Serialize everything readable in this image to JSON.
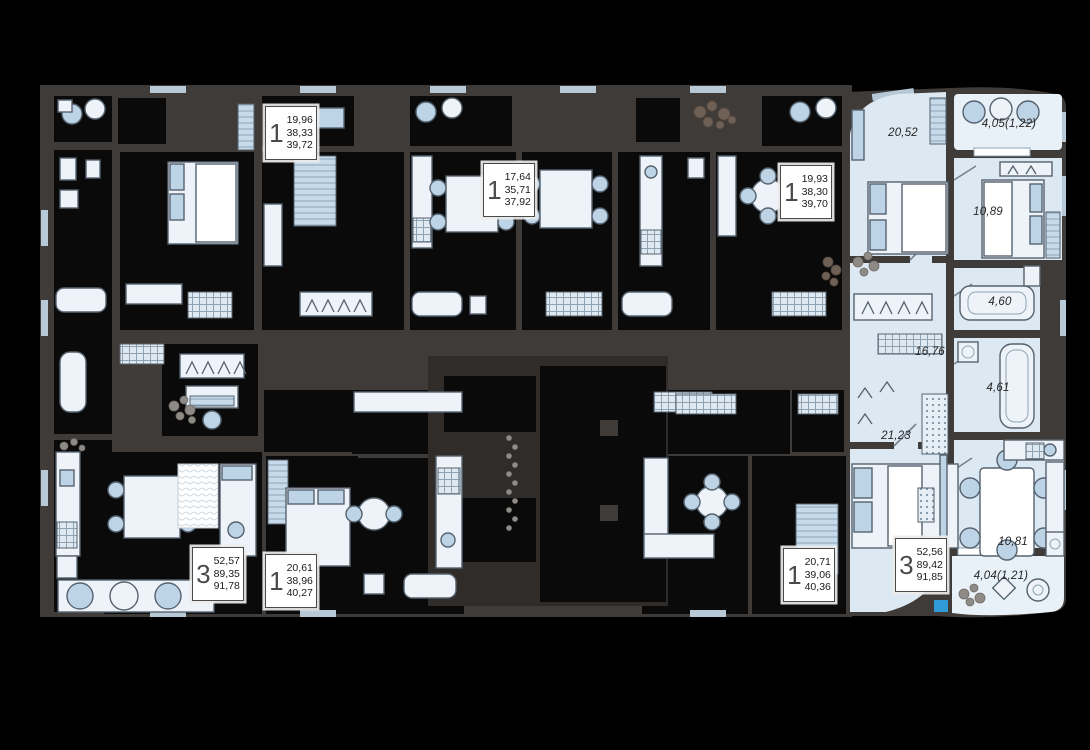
{
  "plan": {
    "name": "residential-floor-plan",
    "colors": {
      "background": "#000000",
      "wall": "#3f3b38",
      "room_dark": "#0a0a0a",
      "apartment_floor": "#dce8f2",
      "balcony_floor": "#e9f1f8",
      "furniture": "#bdd4e7",
      "entrance_marker": "#2f9ad6",
      "info_box_bg": "#ffffff"
    }
  },
  "apartment": {
    "name": "highlighted-apartment",
    "rooms": [
      {
        "label": "20,52"
      },
      {
        "label": "4,05(1,22)"
      },
      {
        "label": "10,89"
      },
      {
        "label": "4,60"
      },
      {
        "label": "4,61"
      },
      {
        "label": "16,76"
      },
      {
        "label": "21,23"
      },
      {
        "label": "10,81"
      },
      {
        "label": "4,04(1,21)"
      }
    ]
  },
  "units": [
    {
      "rooms_count": "1",
      "areas": [
        "19,96",
        "38,33",
        "39,72"
      ]
    },
    {
      "rooms_count": "1",
      "areas": [
        "17,64",
        "35,71",
        "37,92"
      ]
    },
    {
      "rooms_count": "1",
      "areas": [
        "19,93",
        "38,30",
        "39,70"
      ]
    },
    {
      "rooms_count": "3",
      "areas": [
        "52,57",
        "89,35",
        "91,78"
      ]
    },
    {
      "rooms_count": "1",
      "areas": [
        "20,61",
        "38,96",
        "40,27"
      ]
    },
    {
      "rooms_count": "1",
      "areas": [
        "20,71",
        "39,06",
        "40,36"
      ]
    },
    {
      "rooms_count": "3",
      "areas": [
        "52,56",
        "89,42",
        "91,85"
      ]
    }
  ]
}
